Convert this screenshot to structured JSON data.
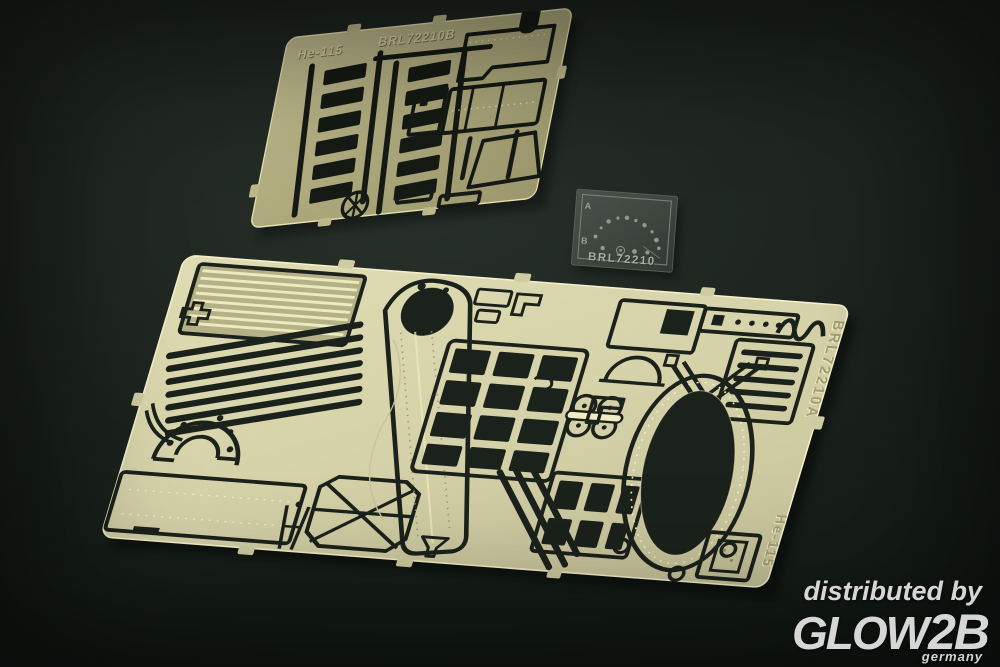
{
  "photo": {
    "background_color": "#141a16",
    "film_slide": {
      "product_code": "BRL72210",
      "marking_top": "A",
      "marking_bottom": "B",
      "base_color": "#3e453e",
      "text_color": "#a2b0a2"
    },
    "fret_small": {
      "aircraft_label": "He-115",
      "product_code": "BRL72210B",
      "base_color": "#b2ac80",
      "highlight_color": "#e6e1af",
      "cutout_color": "#151a14"
    },
    "fret_large": {
      "product_code": "BRL72210A",
      "aircraft_label": "He-115",
      "base_color": "#d7d3aa",
      "highlight_color": "#f4f1ca",
      "cutout_color": "#1b211b"
    },
    "watermark": {
      "line1": "distributed by",
      "brand_glow": "GLOW",
      "brand_2b": "2B",
      "country": "germany",
      "color": "#d6d6d6"
    }
  }
}
